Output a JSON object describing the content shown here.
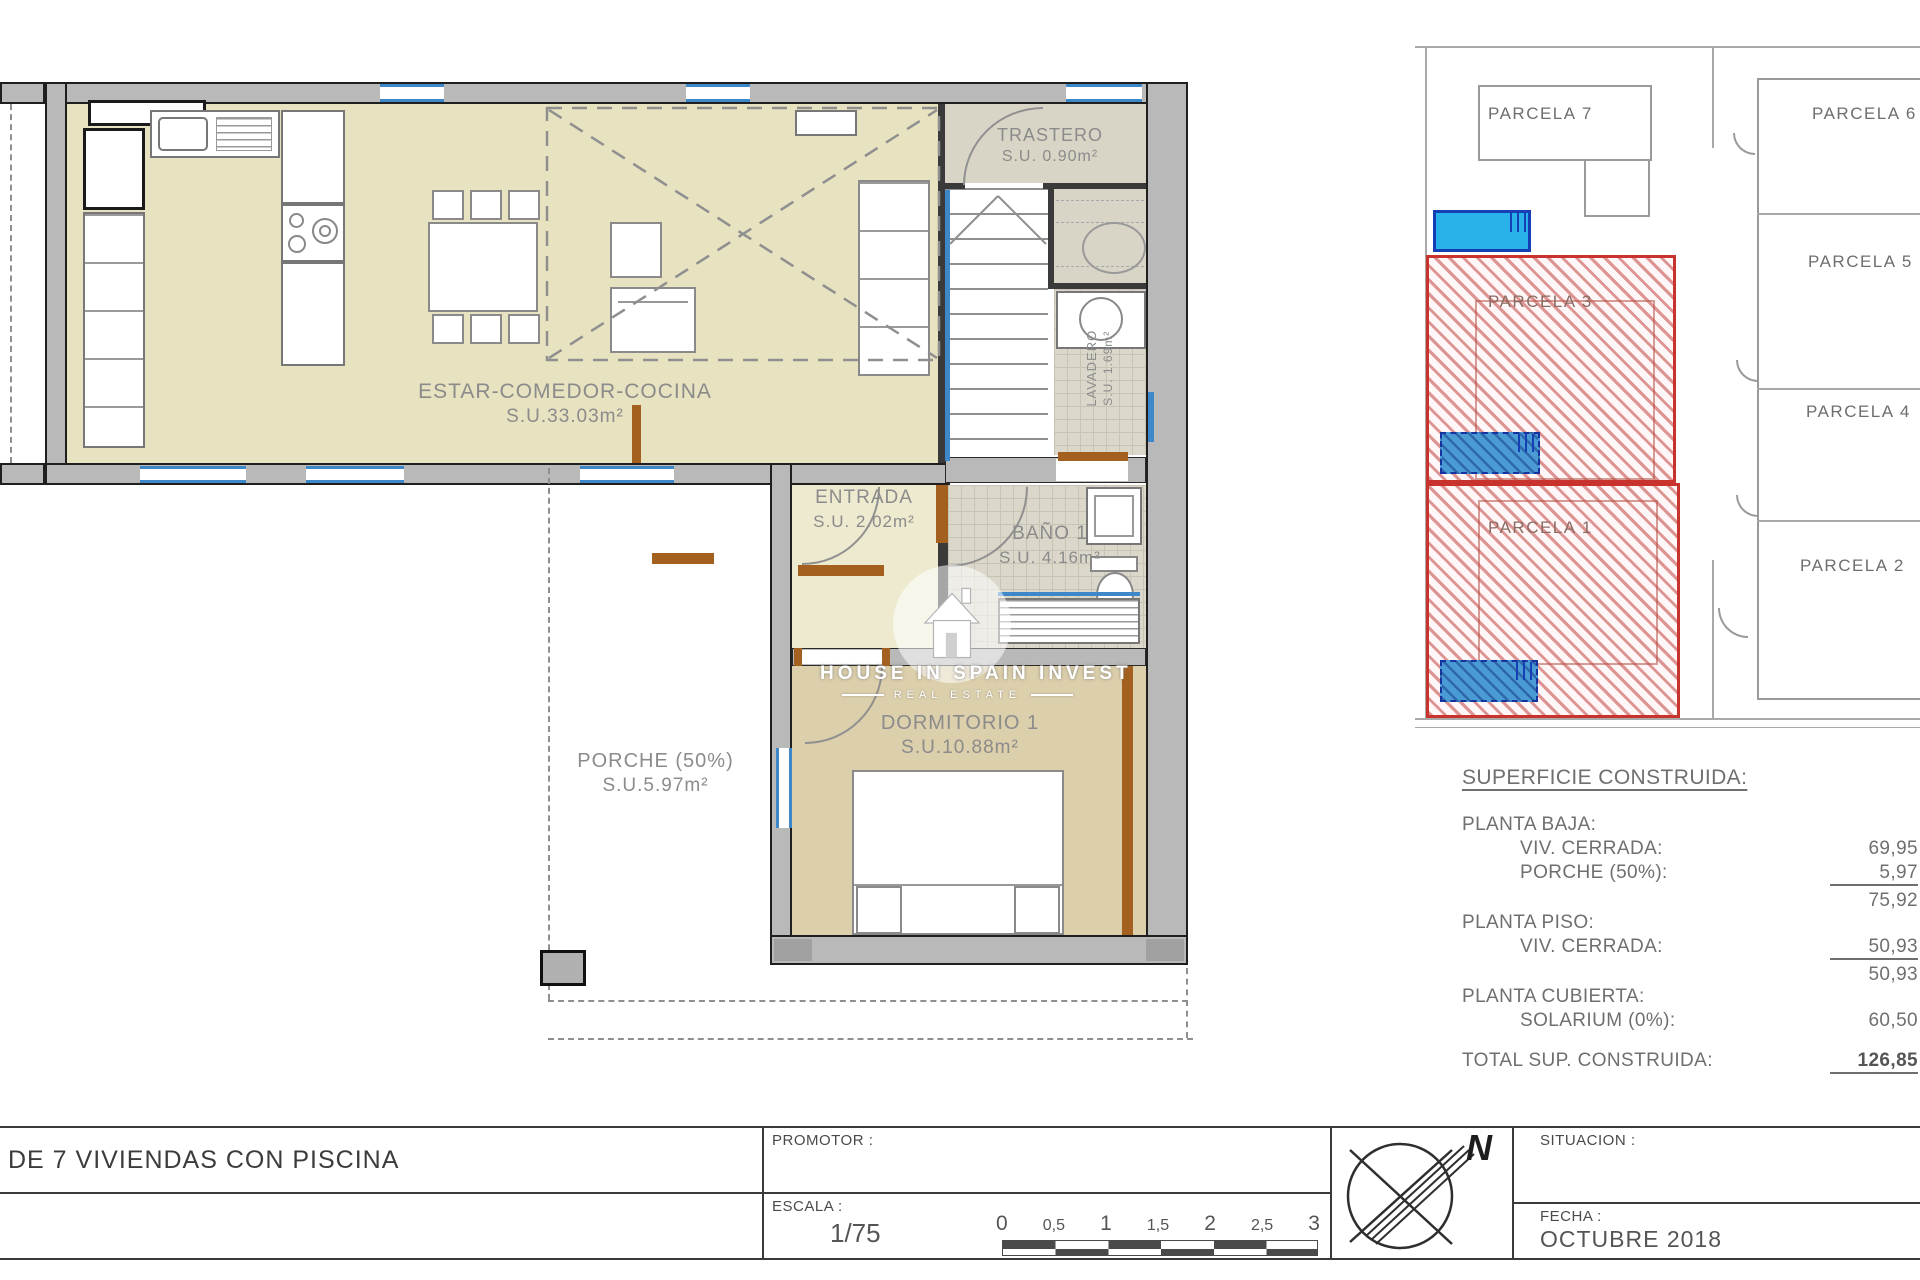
{
  "floor_plan": {
    "living": {
      "name": "ESTAR-COMEDOR-COCINA",
      "area": "S.U.33.03m²"
    },
    "trastero": {
      "name": "TRASTERO",
      "area": "S.U. 0.90m²"
    },
    "lavadero": {
      "name": "LAVADERO",
      "area": "S.U. 1.69m²"
    },
    "entrada": {
      "name": "ENTRADA",
      "area": "S.U. 2.02m²"
    },
    "bano": {
      "name": "BAÑO 1",
      "area": "S.U. 4.16m²"
    },
    "dormitorio": {
      "name": "DORMITORIO 1",
      "area": "S.U.10.88m²"
    },
    "porche": {
      "name": "PORCHE (50%)",
      "area": "S.U.5.97m²"
    },
    "watermark_line1": "HOUSE IN SPAIN INVEST",
    "watermark_line2": "REAL ESTATE"
  },
  "site_plan": {
    "parcela_7": "PARCELA 7",
    "parcela_6": "PARCELA 6",
    "parcela_5": "PARCELA 5",
    "parcela_4": "PARCELA 4",
    "parcela_3": "PARCELA 3",
    "parcela_2": "PARCELA 2",
    "parcela_1": "PARCELA 1"
  },
  "surface_table": {
    "title": "SUPERFICIE CONSTRUIDA:",
    "planta_baja_heading": "PLANTA BAJA:",
    "row_viv_cerrada_baja": {
      "label": "VIV. CERRADA:",
      "value": "69,95"
    },
    "row_porche": {
      "label": "PORCHE (50%):",
      "value": "5,97"
    },
    "subtotal_baja": "75,92",
    "planta_piso_heading": "PLANTA PISO:",
    "row_viv_cerrada_piso": {
      "label": "VIV. CERRADA:",
      "value": "50,93"
    },
    "subtotal_piso": "50,93",
    "planta_cubierta_heading": "PLANTA CUBIERTA:",
    "row_solarium": {
      "label": "SOLARIUM (0%):",
      "value": "60,50"
    },
    "total_label": "TOTAL SUP. CONSTRUIDA:",
    "total_value": "126,85"
  },
  "title_block": {
    "project_title": "DE 7 VIVIENDAS CON PISCINA",
    "promotor_label": "PROMOTOR :",
    "escala_label": "ESCALA :",
    "escala_value": "1/75",
    "scale_ticks": [
      "0",
      "0,5",
      "1",
      "1,5",
      "2",
      "2,5",
      "3"
    ],
    "situacion_label": "SITUACION :",
    "fecha_label": "FECHA :",
    "fecha_value": "OCTUBRE 2018",
    "north_label": "N"
  },
  "colors": {
    "wall_gray": "#b9b9b9",
    "living_floor": "#e7e2c0",
    "dorm_floor": "#dccfab",
    "door_brown": "#a4601f",
    "window_blue": "#3e87c9",
    "parcel_highlight": "#c9332e",
    "pool_blue": "#29b1ea"
  }
}
